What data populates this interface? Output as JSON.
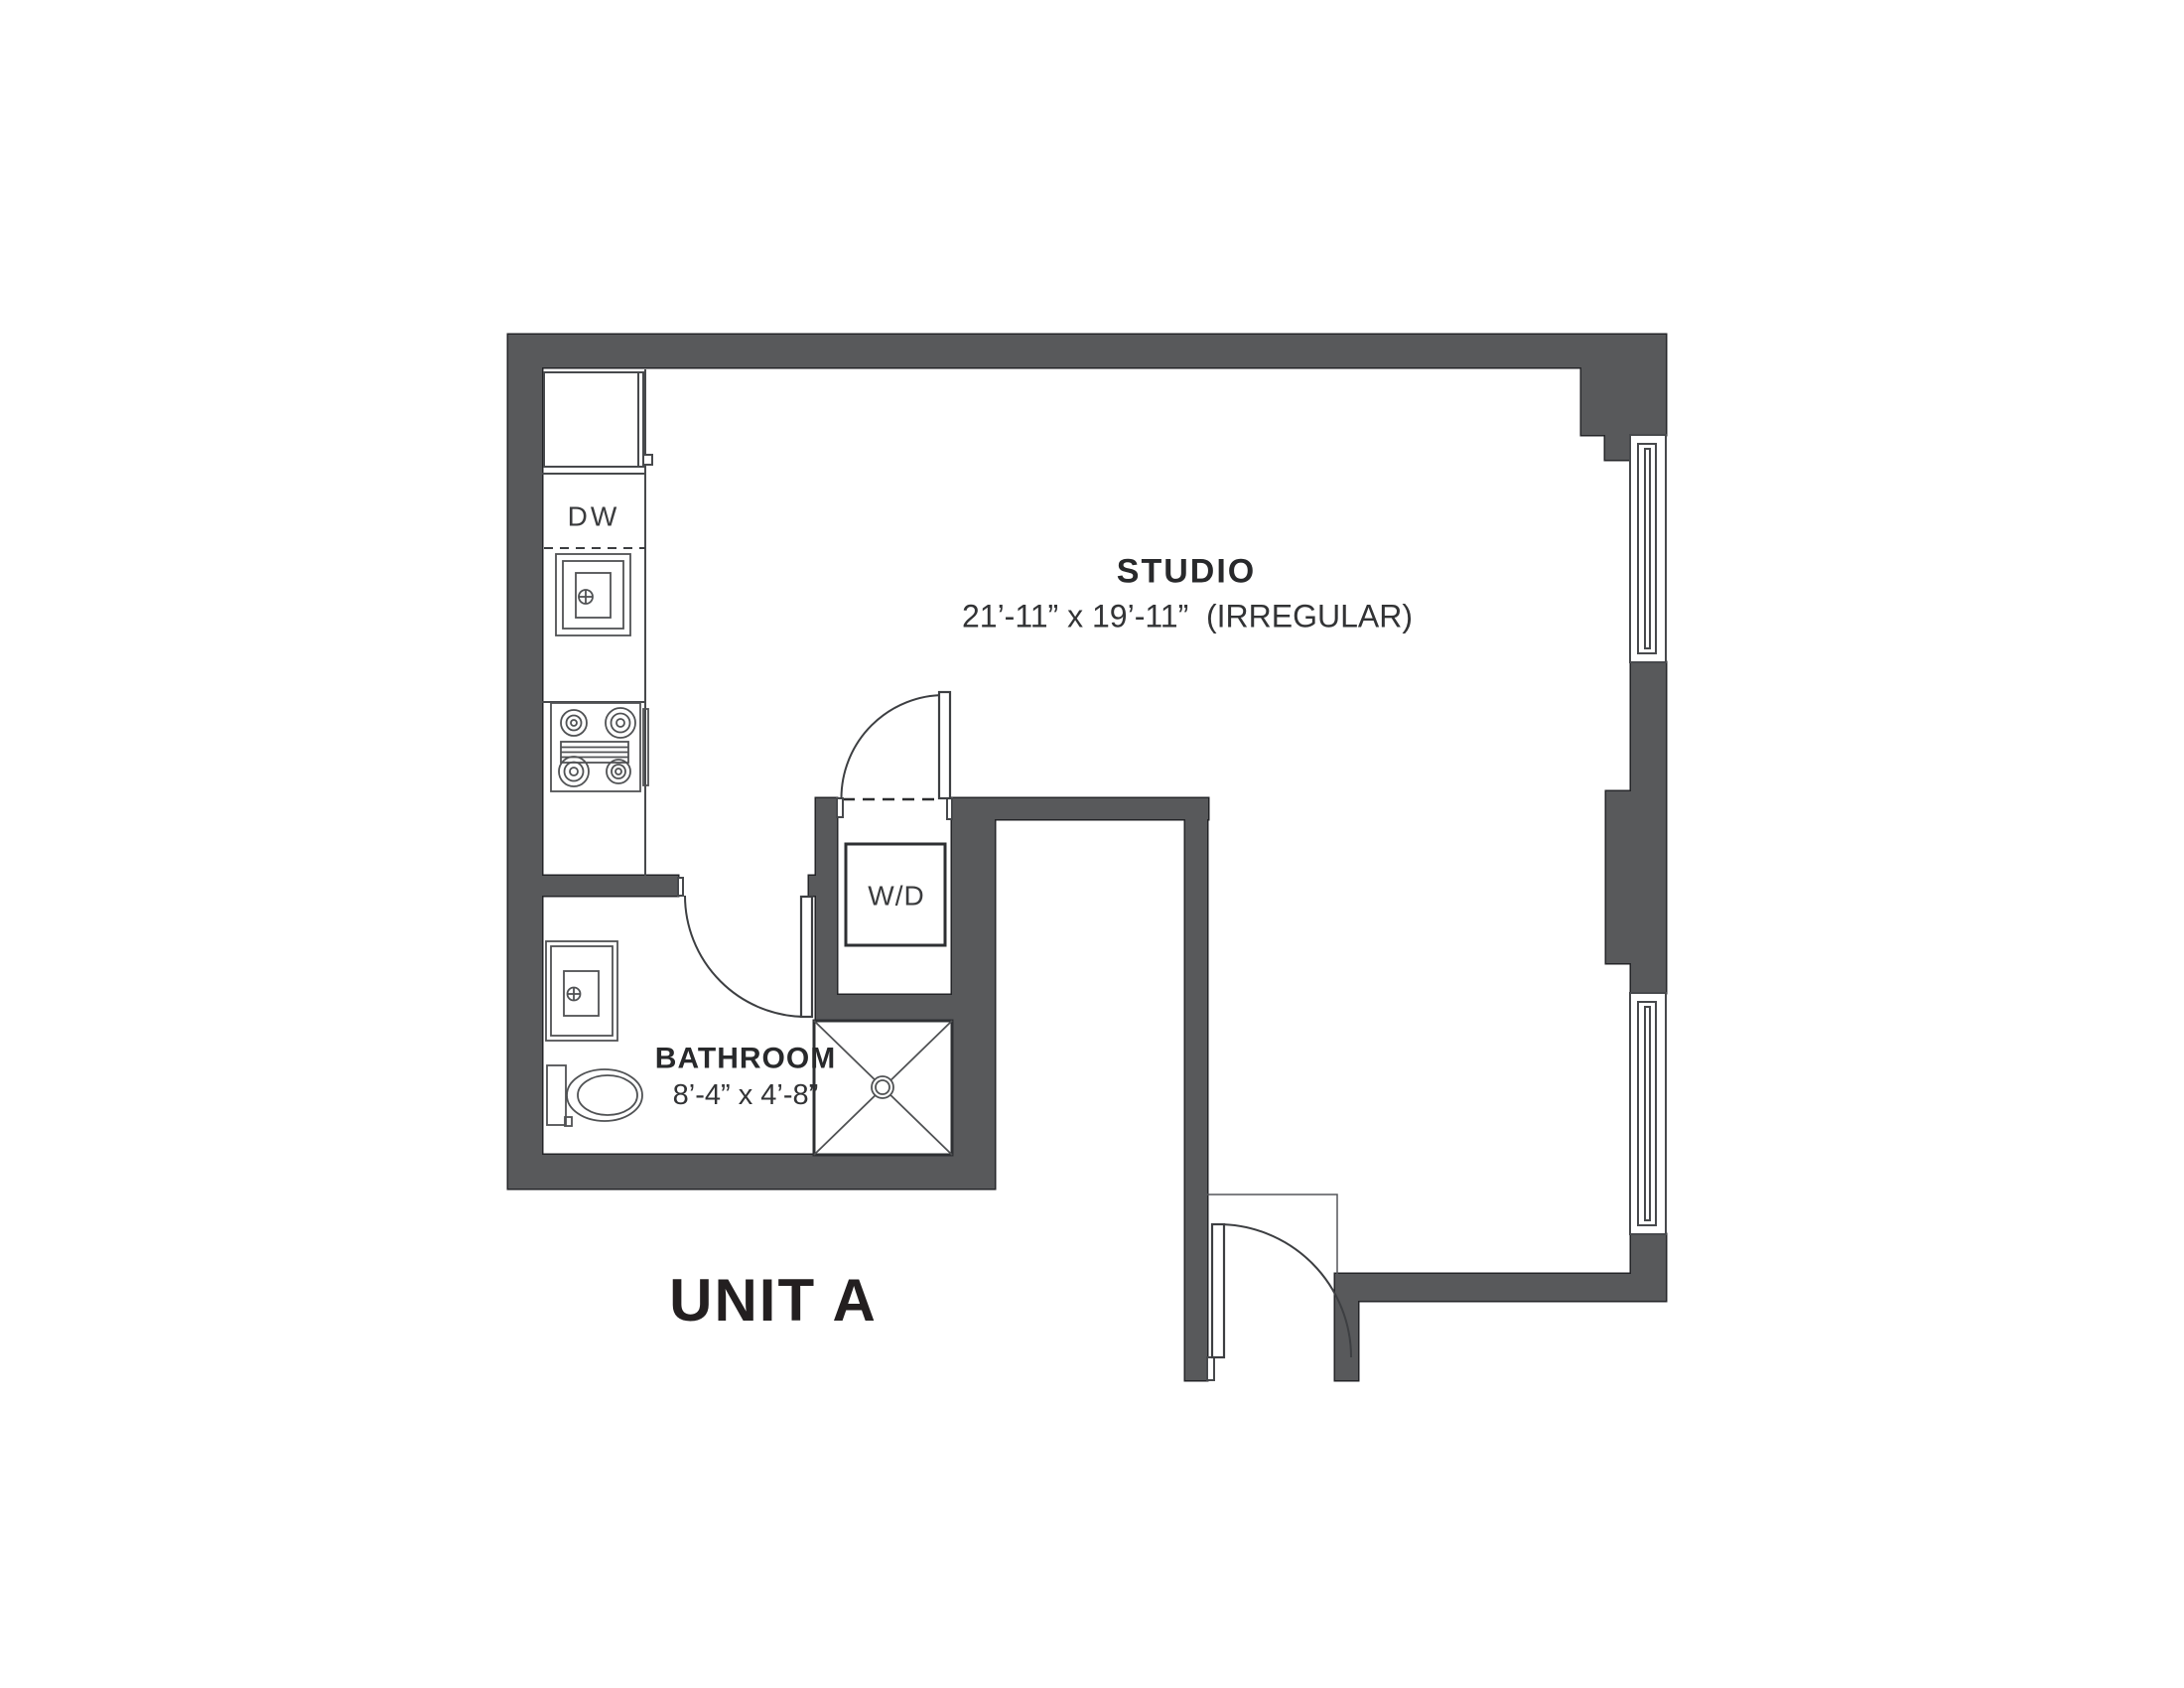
{
  "title": "UNIT A",
  "rooms": {
    "studio": {
      "name": "STUDIO",
      "dimensions": "21’-11” x 19’-11”  (IRREGULAR)"
    },
    "bathroom": {
      "name": "BATHROOM",
      "dimensions": "8’-4” x 4’-8”"
    }
  },
  "appliances": {
    "dishwasher": "DW",
    "washer_dryer": "W/D"
  },
  "colors": {
    "wall": "#58595B",
    "outline": "#242528",
    "fixture_line": "#505254",
    "text": "#28292B",
    "background": "#FFFFFF"
  }
}
